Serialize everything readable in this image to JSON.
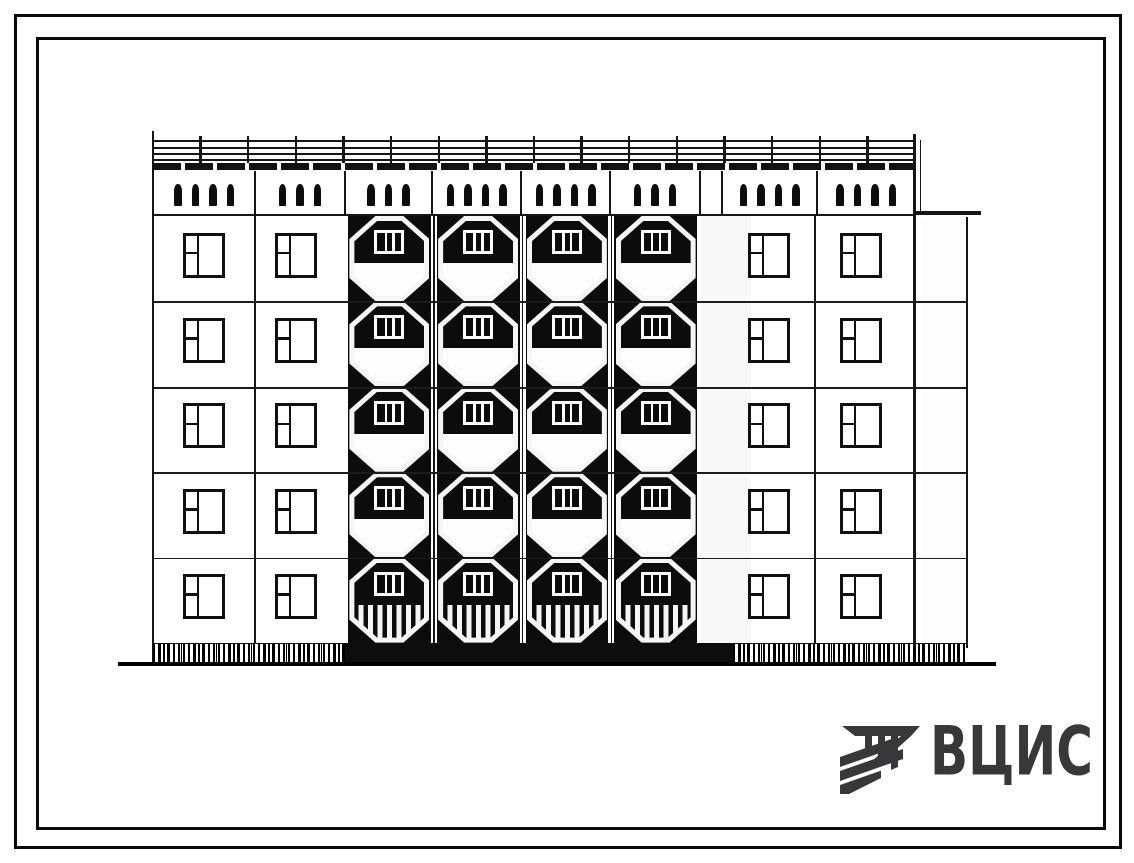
{
  "sheet": {
    "background": "#ffffff",
    "ink": "#111111"
  },
  "logo": {
    "text": "ВЦИС",
    "color": "#38383a",
    "icon": "vcis-hatched-emblem"
  },
  "elevation": {
    "floors": 5,
    "facade": {
      "left_x": 152.5,
      "right_x": 915,
      "top_y": 131,
      "ground_y": 662
    },
    "cornice": {
      "line_ys": [
        140,
        146.5,
        152.5,
        159
      ],
      "band_y": 163,
      "band_h": 7,
      "tick_from": 153,
      "tick_to": 915,
      "tick_count": 17,
      "tick_top": 136,
      "tick_h": 27
    },
    "vent_band": {
      "y": 171,
      "h": 44,
      "slot_y": 183.5,
      "slot_w": 7.5,
      "slot_h": 22,
      "slot_gap": 17.5,
      "divider_xs": [
        255,
        345,
        432,
        521,
        610,
        700,
        722,
        817
      ],
      "panels": [
        {
          "x1": 153,
          "x2": 255,
          "vents": 4
        },
        {
          "x1": 255,
          "x2": 345,
          "vents": 3
        },
        {
          "x1": 345,
          "x2": 432,
          "vents": 3
        },
        {
          "x1": 432,
          "x2": 521,
          "vents": 4
        },
        {
          "x1": 521,
          "x2": 610,
          "vents": 4
        },
        {
          "x1": 610,
          "x2": 700,
          "vents": 3
        },
        {
          "x1": 722,
          "x2": 817,
          "vents": 4
        },
        {
          "x1": 817,
          "x2": 915,
          "vents": 4
        }
      ]
    },
    "floor_tops": [
      216,
      301.4,
      386.8,
      472.2,
      557.6
    ],
    "row_h": 85.4,
    "floor_line_ys": [
      301.4,
      386.8,
      472.2,
      557.6
    ],
    "band_bottom_line_y": 213.5,
    "wall_windows": {
      "w": 42,
      "h": 45,
      "top_offset": 16.5,
      "column_centers": [
        204,
        296,
        769,
        861
      ]
    },
    "section_joints": {
      "left_x": 255,
      "right_x": 815
    },
    "balconies": {
      "x": 345,
      "col_w": 88.75,
      "cols": 4,
      "rows": 5,
      "top": 216,
      "bottom": 643,
      "octagon_w": 80,
      "octagon_h": 85,
      "border": 5,
      "window_w": 30,
      "window_h": 24,
      "window_top": 9,
      "parapet_top": 47,
      "ground_row_slats": true
    },
    "shadow_strip": {
      "x": 700.5,
      "w": 50,
      "top": 216,
      "bottom": 643
    },
    "side_wall": {
      "stipple_x": 921,
      "stipple_w": 44,
      "top": 217.5,
      "bottom": 646.5,
      "cornice_y": 211,
      "cornice_x1": 913,
      "cornice_x2": 981,
      "edge_x": 965.5,
      "inner_edge_x": 919.5
    },
    "plinth": {
      "y": 643,
      "h": 19,
      "textured_left_x1": 153,
      "solid_x1": 345,
      "solid_x2": 733,
      "textured_right_x2": 966
    },
    "ground_line": {
      "x1": 118,
      "x2": 996,
      "y": 661.5,
      "h": 4.5
    }
  }
}
